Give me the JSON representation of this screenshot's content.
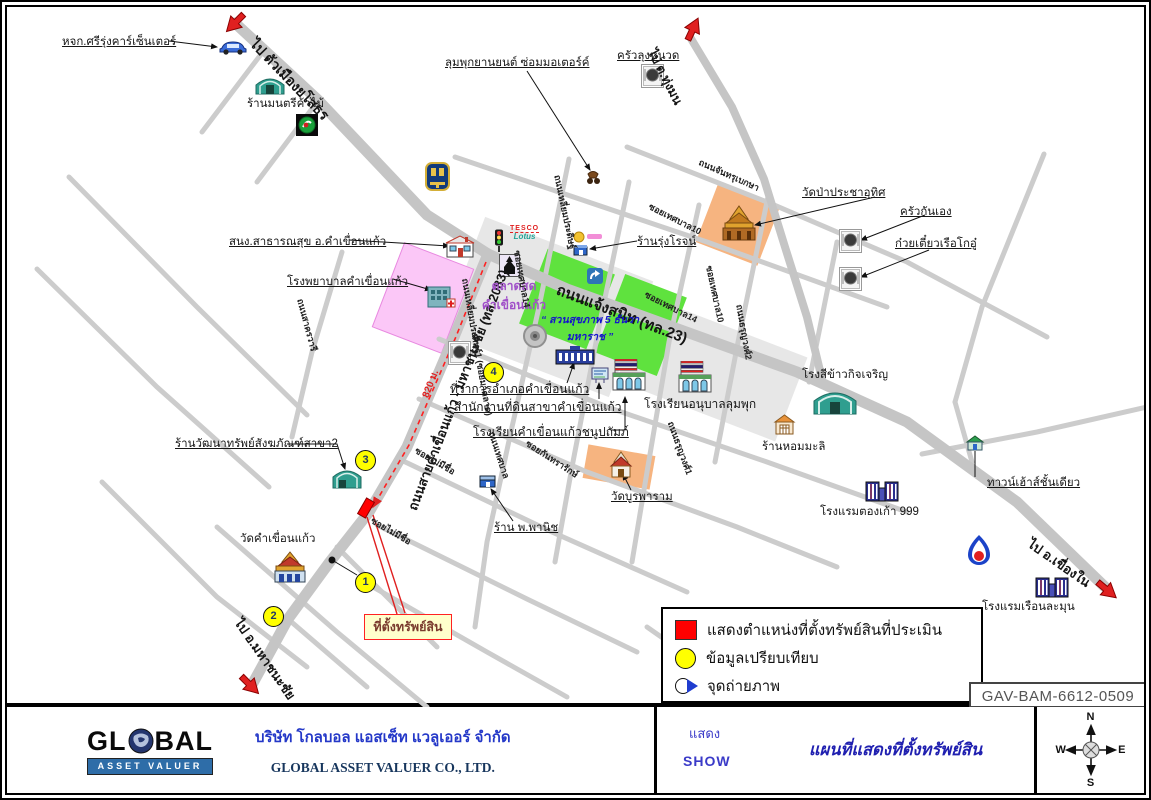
{
  "ref_no": "GAV-BAM-6612-0509",
  "legend": {
    "items": [
      {
        "symbol": "red-square",
        "label": "แสดงตำแหน่งที่ตั้งทรัพย์สินที่ประเมิน"
      },
      {
        "symbol": "yellow-circle",
        "label": "ข้อมูลเปรียบเทียบ"
      },
      {
        "symbol": "photo-point",
        "label": "จุดถ่ายภาพ"
      }
    ]
  },
  "map": {
    "property_label": "ที่ตั้งทรัพย์สิน",
    "comparison_points": {
      "c1": "1",
      "c2": "2",
      "c3": "3",
      "c4": "4"
    },
    "labels": {
      "sri_rung": "หจก.ศรีรุ่งคาร์เซ็นเตอร์",
      "to_yasothon": "ไป ตัวเมืองยโสธร",
      "montri_timber": "ร้านมนตรีค้าไม้",
      "lumphuk_motor": "ลุมพุกยานยนต์ ซ่อมมอเตอร์ค์",
      "khrua_lung_nuat": "ครัวลุงหนวด",
      "to_thung_mon": "ไป ต.ทุ่งมน",
      "wat_pa": "วัดป่าประชาอุทิศ",
      "khrua_kan_eng": "ครัวกันเอง",
      "noodle_boat": "ก๋วยเตี๋ยวเรือโกอู๋",
      "chanthrubeksa_rd": "ถนนจันทรุเบกษา",
      "health_office": "สนง.สาธารณสุข อ.คำเขื่อนแก้ว",
      "hospital": "โรงพยาบาลคำเขื่อนแก้ว",
      "rd_2083": "ถนนสายคำเขื่อนแก้ว - มหาชนะชัย (ทล.2083)",
      "dist_820m": "820 ม.",
      "fresh_market": "ตลาดสด คำเขื่อนแก้ว",
      "chaengsanit_rd": "ถนนแจ้งสนิท (ทล.23)",
      "park": "“ สวนสุขภาพ 5 ธันวา มหาราช ”",
      "liam_pradit_rd": "ถนนเหลี่ยมประดิษฐ์",
      "liam_pradit1_rd": "ถนนเหลี่ยมประดิษฐ์1 (ซอยมาตลาด)",
      "rung_rot_shop": "ร้านรุ่งโรจน์",
      "soi_thetsaban10a": "ซอยเทศบาล10",
      "soi_thetsaban14a": "ซอยเทศบาล14",
      "soi_thetsaban10b": "ซอยเทศบาล10",
      "soi_thetsaban14b": "ซอยเทศบาล14",
      "thorunyawong2_rd": "ถนนธรุญวงศ์2",
      "thorunyawong1_rd": "ถนนธรุญวงศ์1",
      "district_office": "ที่ว่าการอำเภอคำเขื่อนแก้ว",
      "land_office": "สำนักงานที่ดินสาขาคำเขื่อนแก้ว",
      "school_chanupatham": "โรงเรียนคำเขื่อนแก้วชนูปถัมภ์",
      "school_anuban": "โรงเรียนอนุบาลลุมพุก",
      "rice_mill": "โรงสีข้าวกิจเจริญ",
      "hom_mali_shop": "ร้านหอมมะลิ",
      "wat_burapha": "วัดบูรพาราม",
      "pho_phanit_shop": "ร้าน พ.พานิช",
      "soi_kantharak": "ซอยกันทรารักษ์",
      "thetsaban_rd": "ถนนเทศบาล",
      "soi_no_name_a": "ซอยไม่มีชื่อ",
      "soi_no_name_b": "ซอยไม่มีชื่อ",
      "watthanasap_shop": "ร้านวัฒนาทรัพย์สังฆภัณฑ์สาขา2",
      "wat_kham": "วัดคำเขื่อนแก้ว",
      "to_mahachanachai": "ไป อ.มหาชนะชัย",
      "townhouse": "ทาวน์เฮ้าส์ชั้นเดียว",
      "tong_kao_hotel": "โรงแรมตองเก้า 999",
      "to_khueang_nai": "ไป อ.เขื่องใน",
      "ruean_lamun_hotel": "โรงแรมเรือนละมุน",
      "sakhon_wari_rd": "ถนนสาครวารี"
    },
    "logos": {
      "tesco": "TESCO",
      "lotus": "Lotus"
    },
    "icons": [
      "car-icon",
      "warehouse-icon",
      "pt-station-logo",
      "motorbike-icon",
      "dish-icon",
      "baac-bank-logo",
      "traffic-light-icon",
      "tesco-lotus-logo",
      "shrine-icon",
      "health-office-icon",
      "hospital-icon",
      "clock-tower-icon",
      "district-office-icon",
      "land-office-icon",
      "school-flag-icon",
      "temple-icon",
      "small-shop-icon",
      "gold-shop-icon",
      "blue-sign-icon",
      "rice-mill-icon",
      "orange-shop-icon",
      "hotel-icon",
      "ptt-logo",
      "townhouse-icon",
      "property-marker",
      "photo-dot"
    ],
    "colors": {
      "road": "#C9C9C9",
      "block": "#E7E7E7",
      "park_green": "#5FE23E",
      "hospital_pink": "#FBC7F7",
      "temple_orange": "#F6B480",
      "marker_red": "#FF0000",
      "compare_yellow": "#FFFF00",
      "route_red": "#FF2020",
      "market_purple": "#A050C8",
      "park_text_blue": "#1414CC"
    }
  },
  "footer": {
    "logo": {
      "gl": "GL",
      "bal": "BAL",
      "banner": "ASSET VALUER"
    },
    "company_th": "บริษัท โกลบอล แอสเซ็ท แวลูเออร์ จำกัด",
    "company_en": "GLOBAL ASSET VALUER CO., LTD.",
    "show_th": "แสดง",
    "show_en": "SHOW",
    "map_title": "แผนที่แสดงที่ตั้งทรัพย์สิน",
    "compass": {
      "n": "N",
      "e": "E",
      "s": "S",
      "w": "W"
    }
  }
}
